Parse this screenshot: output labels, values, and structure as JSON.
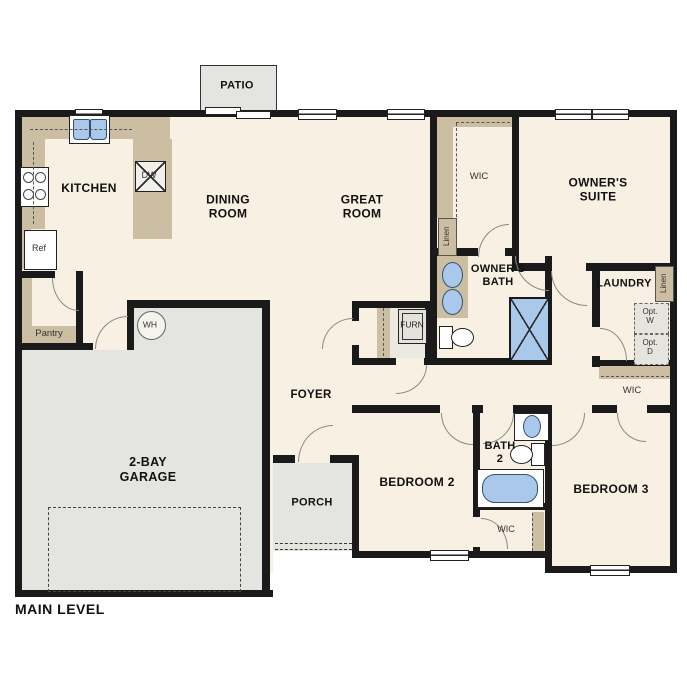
{
  "title": "MAIN LEVEL",
  "rooms": {
    "kitchen": "KITCHEN",
    "dining": "DINING\nROOM",
    "great": "GREAT\nROOM",
    "patio": "PATIO",
    "owners_suite": "OWNER'S\nSUITE",
    "owners_bath": "OWNER'S\nBATH",
    "wic": "WIC",
    "laundry": "LAUNDRY",
    "foyer": "FOYER",
    "porch": "PORCH",
    "bedroom2": "BEDROOM 2",
    "bedroom3": "BEDROOM 3",
    "bath2": "BATH\n2",
    "garage": "2-BAY\nGARAGE",
    "pantry": "Pantry"
  },
  "fixtures": {
    "ref": "Ref",
    "dw": "DW",
    "wh": "WH",
    "furn": "FURN",
    "linen": "Linen",
    "opt_w": "Opt.\nW",
    "opt_d": "Opt.\nD"
  },
  "colors": {
    "wall": "#1a1a1a",
    "floor": "#f8f0e2",
    "hardscape": "#e4e4e0",
    "counter": "#ccbea3",
    "fixture_blue": "#aac9ea"
  }
}
